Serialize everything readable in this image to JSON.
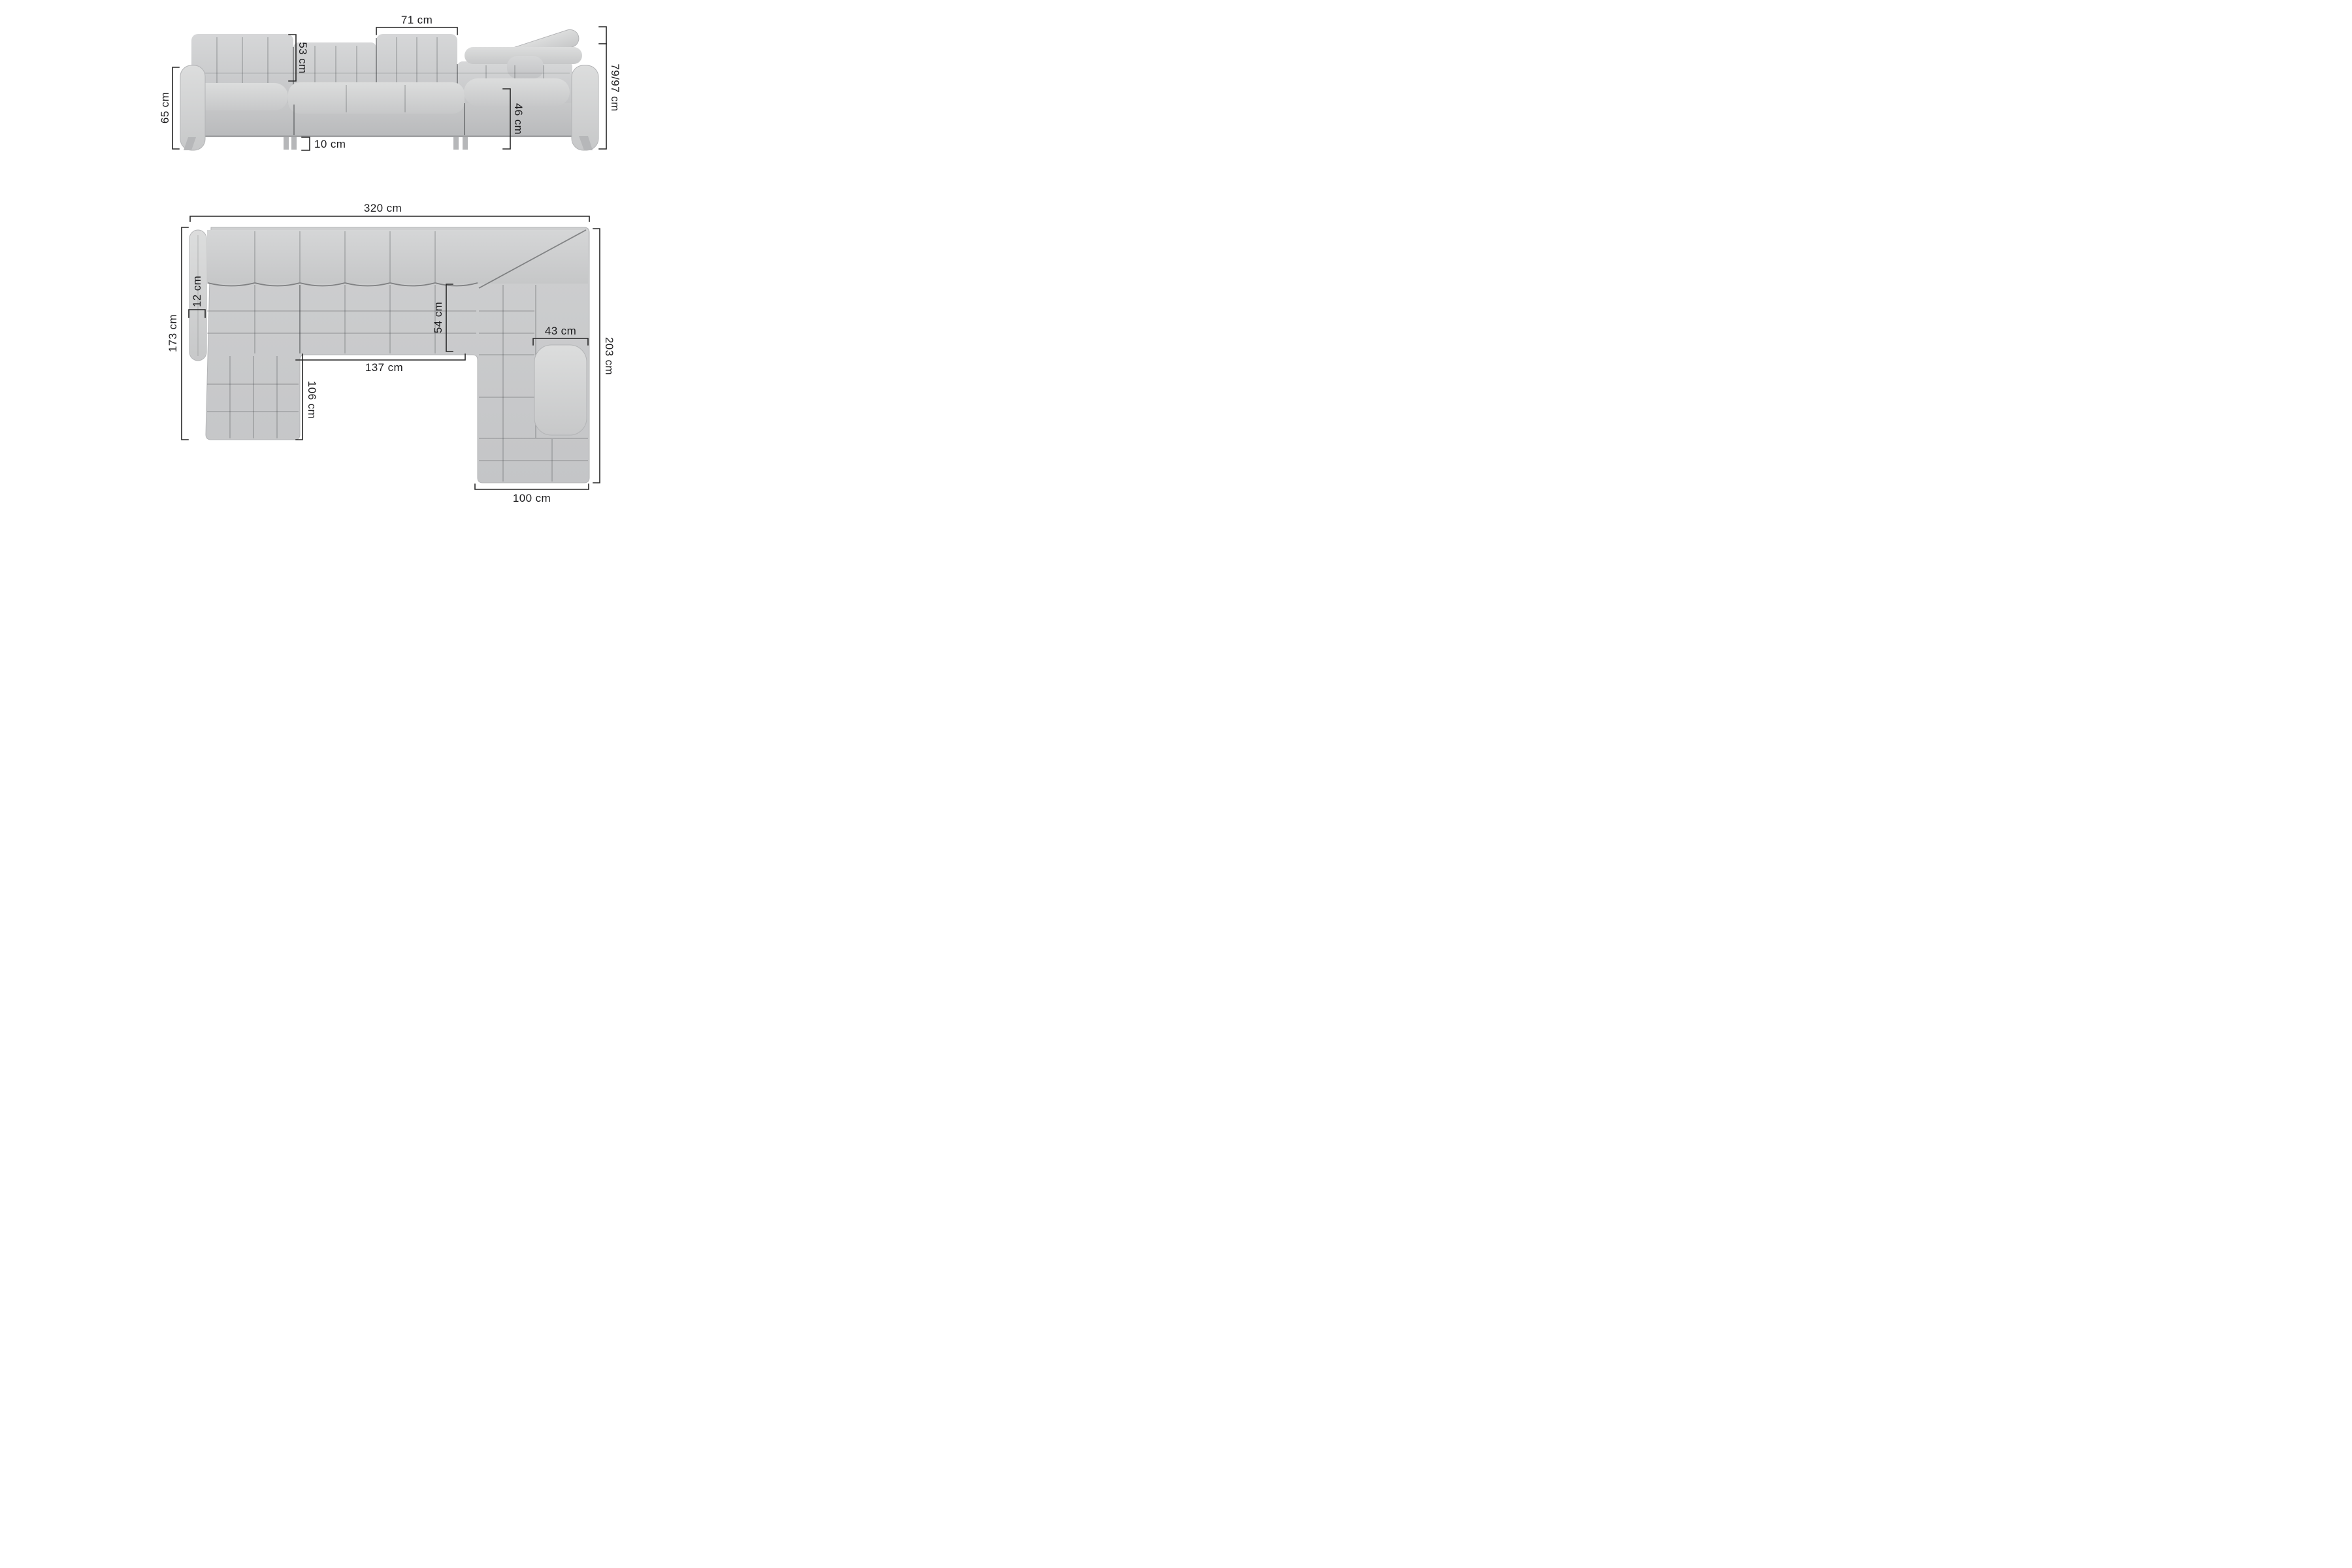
{
  "diagram": {
    "product": "corner-sofa-dimension-diagram",
    "unit": "cm",
    "front_view": {
      "name": "front elevation",
      "dims": {
        "backrest_section_width": {
          "value": 71,
          "label": "71 cm"
        },
        "backrest_height": {
          "value": 53,
          "label": "53 cm"
        },
        "armrest_height": {
          "value": 65,
          "label": "65 cm"
        },
        "height_headrest_range": {
          "value": "79/97",
          "label": "79/97 cm"
        },
        "seat_height": {
          "value": 46,
          "label": "46 cm"
        },
        "leg_height": {
          "value": 10,
          "label": "10 cm"
        }
      }
    },
    "plan_view": {
      "name": "top view",
      "dims": {
        "total_width": {
          "value": 320,
          "label": "320 cm"
        },
        "left_depth": {
          "value": 173,
          "label": "173 cm"
        },
        "back_armrest_width": {
          "value": 12,
          "label": "12 cm"
        },
        "seat_depth": {
          "value": 54,
          "label": "54 cm"
        },
        "inner_width": {
          "value": 137,
          "label": "137 cm"
        },
        "left_chaise_length": {
          "value": 106,
          "label": "106 cm"
        },
        "side_armrest_width": {
          "value": 43,
          "label": "43 cm"
        },
        "total_depth": {
          "value": 203,
          "label": "203 cm"
        },
        "right_chaise_width": {
          "value": 100,
          "label": "100 cm"
        }
      }
    },
    "colors": {
      "background": "#ffffff",
      "sofa_light": "#d7d8d9",
      "sofa_mid": "#c9cacb",
      "sofa_dark": "#bfc0c1",
      "seam": "#707274",
      "dimension_line": "#262626",
      "label_text": "#1d1d1f"
    }
  }
}
